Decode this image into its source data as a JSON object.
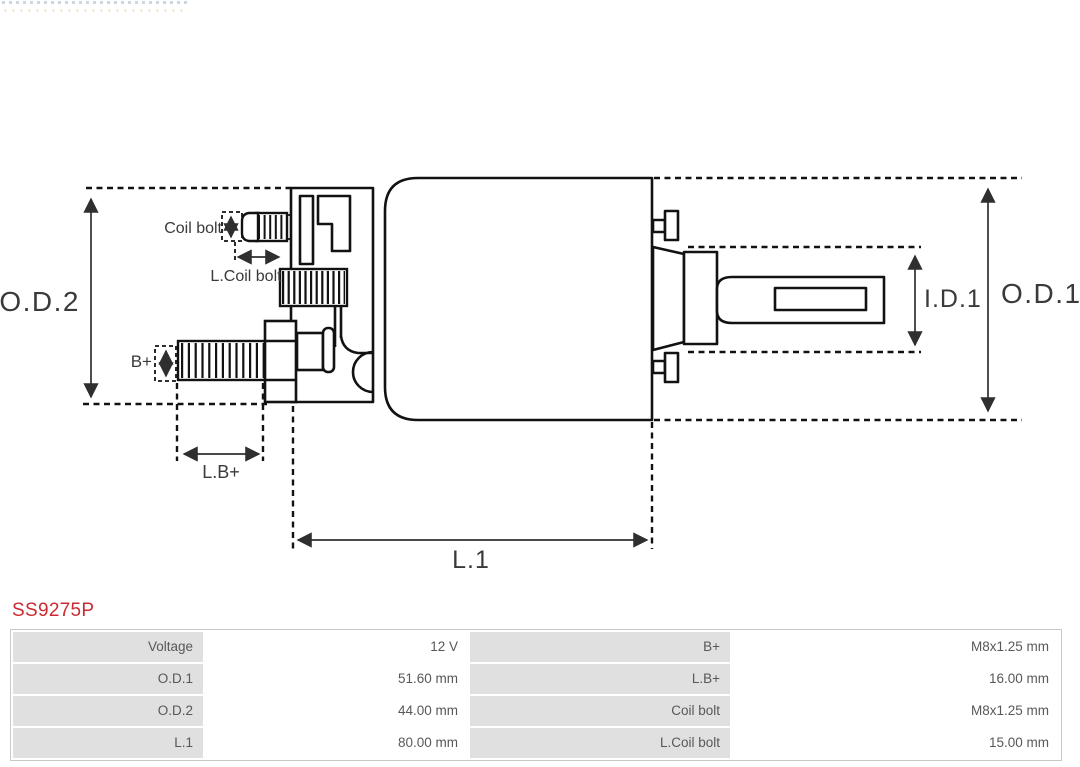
{
  "part": {
    "number": "SS9275P",
    "color": "#cb2b30"
  },
  "diagram": {
    "type": "starter-solenoid-technical-drawing",
    "line_color": "#121212",
    "dim_color": "#2f2f2f",
    "labels": {
      "od2": "O.D.2",
      "od1": "O.D.1",
      "id1": "I.D.1",
      "l1": "L.1",
      "b_plus": "B+",
      "l_b_plus": "L.B+",
      "coil_bolt": "Coil bolt",
      "l_coil_bolt": "L.Coil bolt"
    }
  },
  "spec_table": {
    "label_bg": "#e0e0e0",
    "border_color": "#c9c9c9",
    "text_color": "#58585a",
    "rows": [
      [
        {
          "label": "Voltage",
          "value": "12 V"
        },
        {
          "label": "B+",
          "value": "M8x1.25 mm"
        }
      ],
      [
        {
          "label": "O.D.1",
          "value": "51.60 mm"
        },
        {
          "label": "L.B+",
          "value": "16.00 mm"
        }
      ],
      [
        {
          "label": "O.D.2",
          "value": "44.00 mm"
        },
        {
          "label": "Coil bolt",
          "value": "M8x1.25 mm"
        }
      ],
      [
        {
          "label": "L.1",
          "value": "80.00 mm"
        },
        {
          "label": "L.Coil bolt",
          "value": "15.00 mm"
        }
      ]
    ]
  }
}
